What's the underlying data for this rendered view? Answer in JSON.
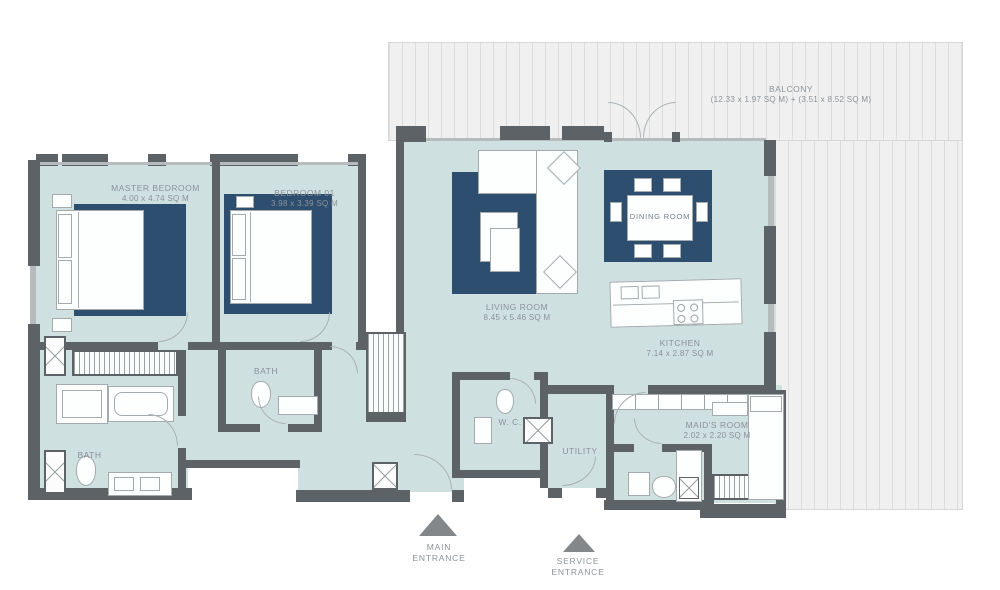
{
  "title": "Apartment Floor Plan",
  "colors": {
    "floor_teal": "#cfe0e1",
    "carpet_navy": "#2e4e70",
    "wall_gray": "#5d6266",
    "balcony_gray": "#f0f0f0",
    "label_gray": "#8b9297"
  },
  "balcony": {
    "label": "BALCONY",
    "dims": "(12.33 x 1.97 SQ M) + (3.51 x 8.52 SQ M)"
  },
  "rooms": {
    "master_bedroom": {
      "label": "MASTER BEDROOM",
      "dims": "4.00 x 4.74 SQ M"
    },
    "bedroom_01": {
      "label": "BEDROOM 01",
      "dims": "3.98 x 3.39 SQ M"
    },
    "living_room": {
      "label": "LIVING ROOM",
      "dims": "8.45 x 5.46 SQ M"
    },
    "dining_room": {
      "label": "DINING ROOM"
    },
    "kitchen": {
      "label": "KITCHEN",
      "dims": "7.14 x 2.87 SQ M"
    },
    "maids_room": {
      "label": "MAID'S ROOM",
      "dims": "2.02 x 2.20 SQ M"
    },
    "bath_master": {
      "label": "BATH"
    },
    "bath_01": {
      "label": "BATH"
    },
    "wc": {
      "label": "W. C."
    },
    "utility": {
      "label": "UTILITY"
    }
  },
  "entrances": {
    "main": {
      "line1": "MAIN",
      "line2": "ENTRANCE"
    },
    "service": {
      "line1": "SERVICE",
      "line2": "ENTRANCE"
    }
  }
}
